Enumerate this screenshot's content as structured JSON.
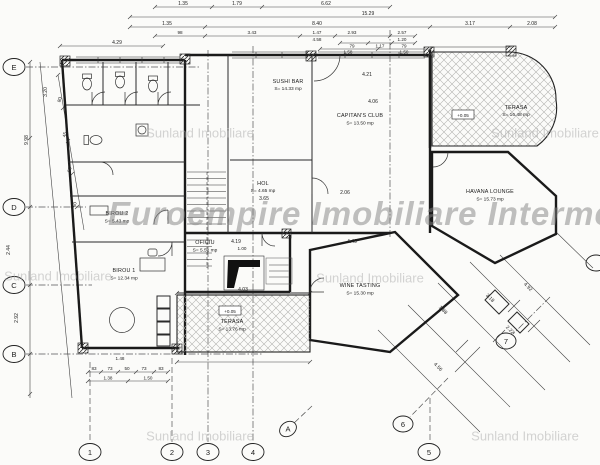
{
  "watermarks": {
    "main": "Euroempire Imobiliare Intermed",
    "tile": "Sunland Imobiliare"
  },
  "rooms": {
    "sushi_bar": {
      "name": "SUSHI BAR",
      "area": "S= 14.33 mp"
    },
    "capitans_club": {
      "name": "CAPITAN'S CLUB",
      "area": "S= 13.50 mp"
    },
    "terasa_top": {
      "name": "TERASA",
      "area": "S= 16.48 mp"
    },
    "havana": {
      "name": "HAVANA LOUNGE",
      "area": "S= 15.73 mp"
    },
    "hol": {
      "name": "HOL",
      "area": "S= 4.65 mp"
    },
    "birou2": {
      "name": "BIROU 2",
      "area": "S= 5.43 mp"
    },
    "birou1": {
      "name": "BIROU 1",
      "area": "S= 12.34 mp"
    },
    "oficiu": {
      "name": "OFICIU",
      "area": "S= 5.52 mp"
    },
    "wine": {
      "name": "WINE TASTING",
      "area": "S= 15.30 mp"
    },
    "terasa_bot": {
      "name": "TERASA",
      "area": "S= 13.76 mp"
    }
  },
  "grid": {
    "left": [
      "E",
      "D",
      "C",
      "B"
    ],
    "bottom": [
      "1",
      "2",
      "3",
      "4",
      "5"
    ],
    "diag": [
      "6",
      "7",
      "A"
    ]
  },
  "elevations": {
    "terasa_top": "+0.05",
    "terasa_bot": "+0.05"
  },
  "dims": {
    "top1": [
      "1.35",
      "1.79",
      "6.62"
    ],
    "top2": [
      "15.29"
    ],
    "top3": [
      "1.35",
      "8.40",
      "3.17",
      "2.08"
    ],
    "top4": [
      "98",
      "3.43",
      "1.47",
      "2.93",
      "2.57"
    ],
    "top5": [
      "4.58",
      "1.20"
    ],
    "top6": [
      "79",
      "1.17",
      "79"
    ],
    "top7": [
      "1.58",
      "1.50"
    ],
    "left": [
      "3.20",
      "9.98",
      "2.44",
      "2.92"
    ],
    "fence": [
      "80",
      "45",
      "50",
      "60"
    ],
    "plan": [
      "4.29",
      "4.21",
      "4.06",
      "3.65",
      "2.06",
      "4.19",
      "1.00",
      "4.49",
      "4.03"
    ],
    "bottom": [
      "83",
      "73",
      "50",
      "73",
      "83",
      "1.38",
      "1.50",
      "1.48"
    ],
    "diag": [
      "4.92",
      "3.18",
      "1.88",
      "2.22",
      "4.56"
    ]
  }
}
